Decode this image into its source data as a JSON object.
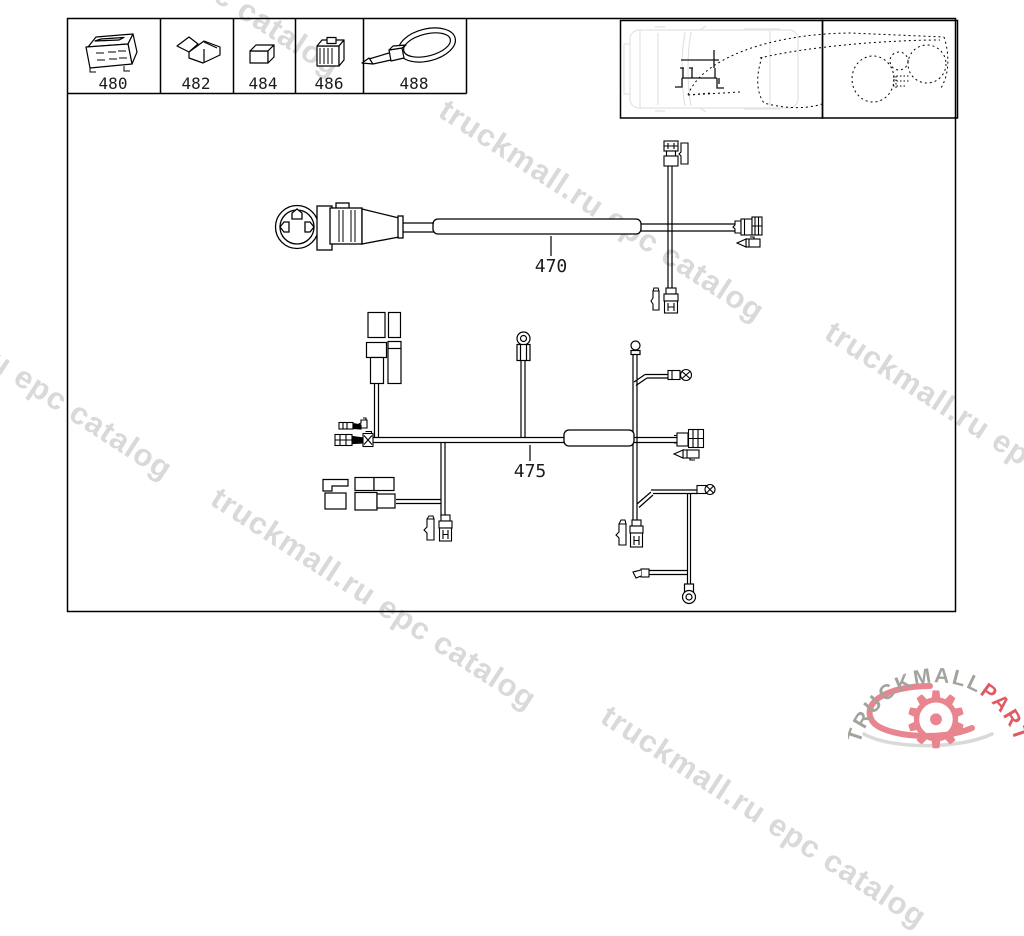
{
  "diagram": {
    "parts_row": [
      {
        "number": "480"
      },
      {
        "number": "482"
      },
      {
        "number": "484"
      },
      {
        "number": "486"
      },
      {
        "number": "488"
      }
    ],
    "harness_labels": [
      {
        "label": "470"
      },
      {
        "label": "475"
      }
    ]
  },
  "watermark": {
    "text": "truckmall.ru epc catalog",
    "color": "#d9d9d9"
  },
  "logo": {
    "brand_gray": "TRUCKMALL",
    "brand_red": "PARTS",
    "gray_color": "#a3a39e",
    "red_color": "#e05a64",
    "gear_color": "#e8858f",
    "swoosh_gray": "#d9d9d5"
  },
  "canvas": {
    "background": "#ffffff",
    "line_color": "#000000",
    "truck_outline_color": "#e2e2e2"
  }
}
